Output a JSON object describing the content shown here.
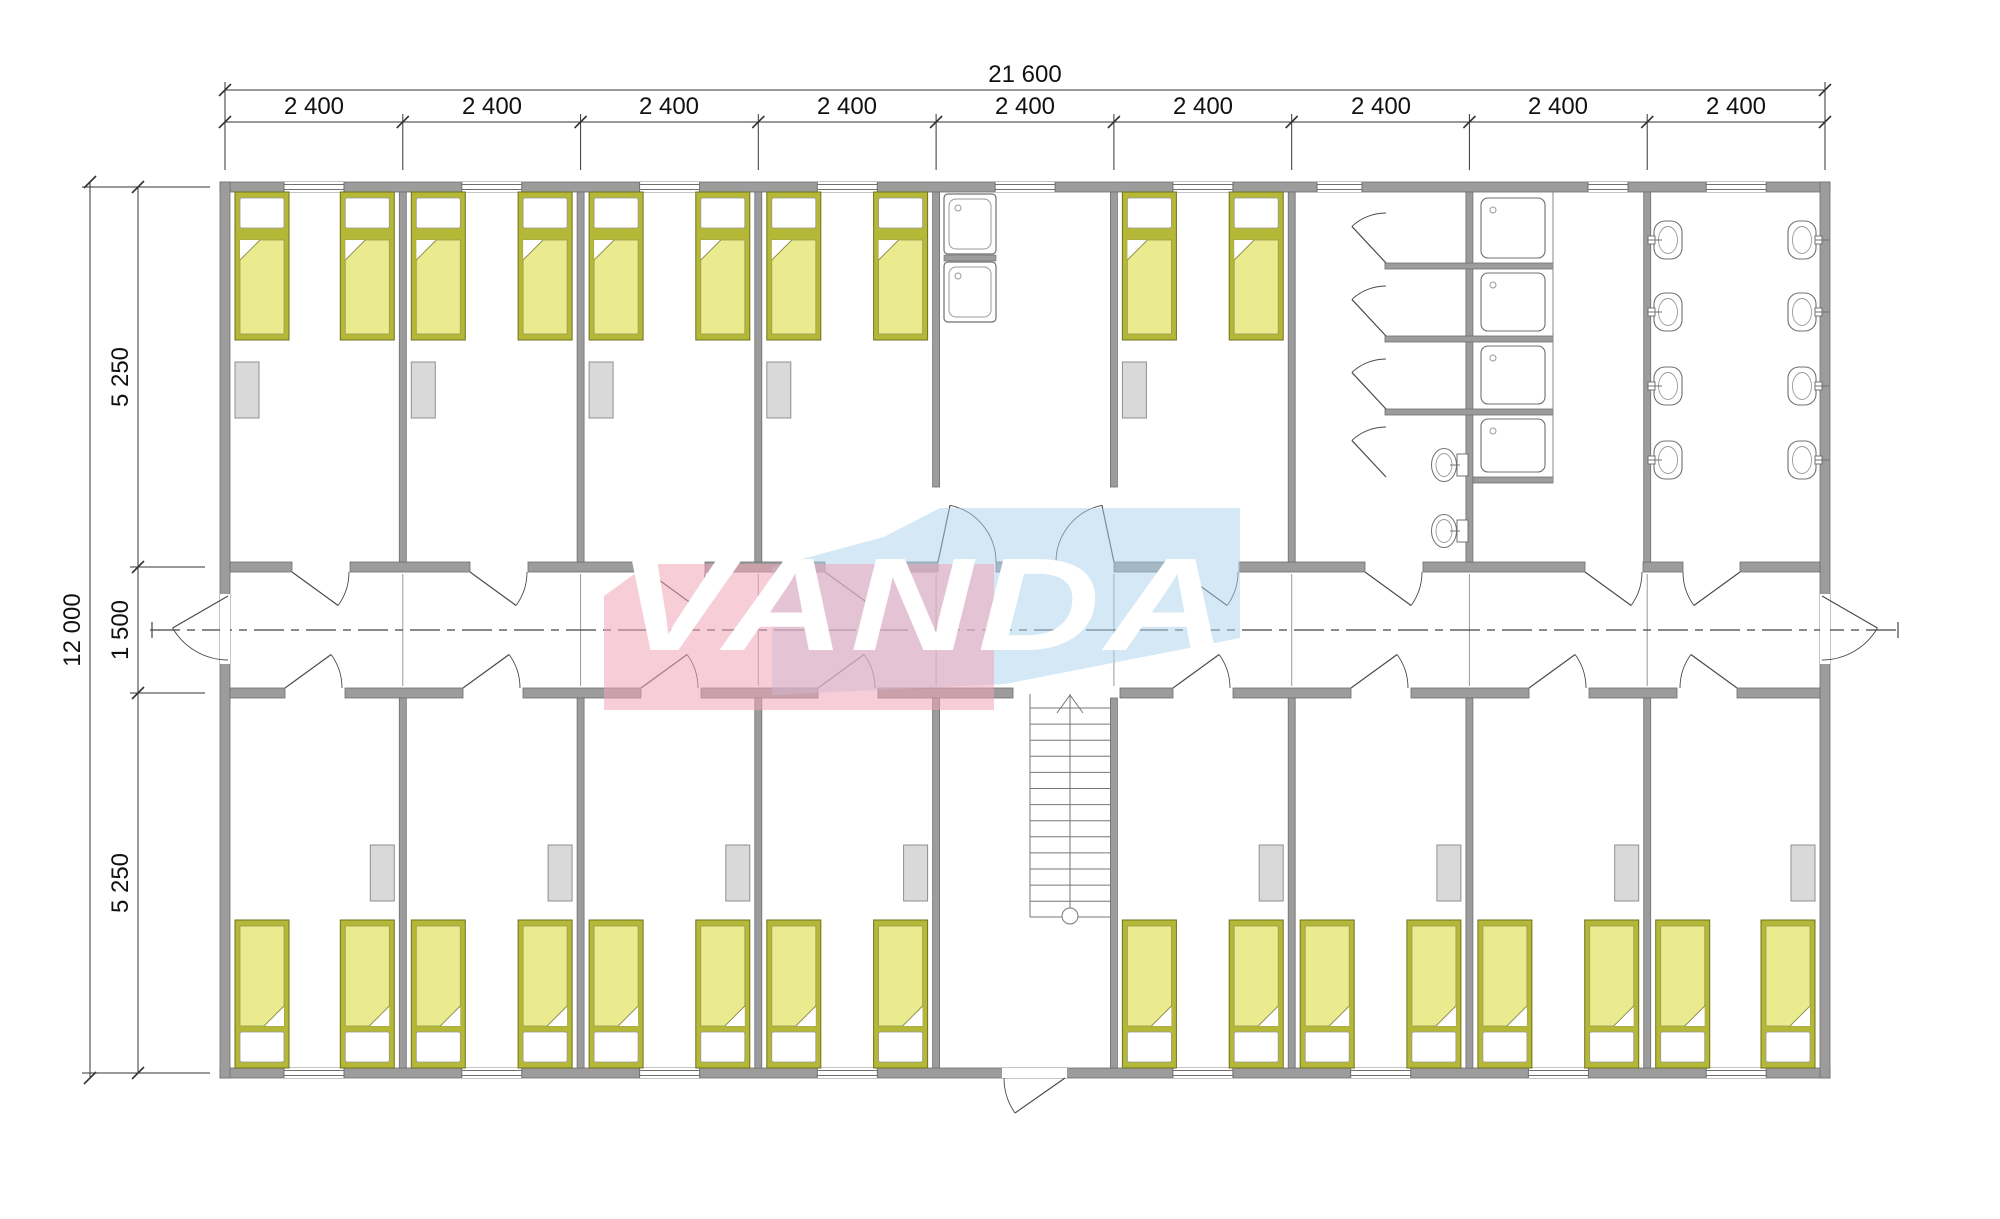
{
  "watermark": {
    "text": "VANDA",
    "pink": "#f0a6b8",
    "blue": "#a9d2ec",
    "pink_opacity": 0.55,
    "blue_opacity": 0.5,
    "text_color": "#ffffff"
  },
  "dims": {
    "total_width": "21 600",
    "module_labels": [
      "2 400",
      "2 400",
      "2 400",
      "2 400",
      "2 400",
      "2 400",
      "2 400",
      "2 400",
      "2 400"
    ],
    "total_height": "12 000",
    "seg_top": "5 250",
    "seg_corridor": "1 500",
    "seg_bottom": "5 250"
  },
  "colors": {
    "wall_fill": "#9c9c9c",
    "wall_stroke": "#6f6f6f",
    "bed_frame": "#b4b836",
    "bed_blanket": "#e9eb8e",
    "bed_pillow": "#ffffff",
    "furniture_fill": "#d9d9d9",
    "furniture_stroke": "#8f8f8f",
    "fixture_stroke": "#707070",
    "door_line": "#4a4a4a",
    "axis_line": "#999999",
    "center_line": "#444444",
    "dim_line": "#333333"
  },
  "building": {
    "modules": 9,
    "corridor_position": "central",
    "rooms_top": [
      {
        "module": 1,
        "type": "bedroom",
        "beds": 2,
        "wardrobes": 1
      },
      {
        "module": 2,
        "type": "bedroom",
        "beds": 2,
        "wardrobes": 1
      },
      {
        "module": 3,
        "type": "bedroom",
        "beds": 2,
        "wardrobes": 1
      },
      {
        "module": 4,
        "type": "bedroom",
        "beds": 2,
        "wardrobes": 1
      },
      {
        "module": 5,
        "type": "kitchen",
        "sinks": 2,
        "corridor_doors": 2
      },
      {
        "module": 6,
        "type": "bedroom",
        "beds": 2,
        "wardrobes": 1
      },
      {
        "module": 7,
        "type": "sanitary-stalls",
        "stalls": 4,
        "toilets": 2
      },
      {
        "module": 8,
        "type": "showers",
        "shower_trays": 4
      },
      {
        "module": 9,
        "type": "washroom",
        "washbasins": 8
      }
    ],
    "rooms_bottom": [
      {
        "module": 1,
        "type": "bedroom",
        "beds": 2,
        "wardrobes": 1
      },
      {
        "module": 2,
        "type": "bedroom",
        "beds": 2,
        "wardrobes": 1
      },
      {
        "module": 3,
        "type": "bedroom",
        "beds": 2,
        "wardrobes": 1
      },
      {
        "module": 4,
        "type": "bedroom",
        "beds": 2,
        "wardrobes": 1
      },
      {
        "module": 5,
        "type": "stair-hall",
        "stairs": 1,
        "entrance_doors": 1
      },
      {
        "module": 6,
        "type": "bedroom",
        "beds": 2,
        "wardrobes": 1
      },
      {
        "module": 7,
        "type": "bedroom",
        "beds": 2,
        "wardrobes": 1
      },
      {
        "module": 8,
        "type": "bedroom",
        "beds": 2,
        "wardrobes": 1
      },
      {
        "module": 9,
        "type": "bedroom",
        "beds": 2,
        "wardrobes": 1
      }
    ],
    "exits": [
      "corridor-left-end",
      "corridor-right-end",
      "main-entrance-bottom-center"
    ]
  }
}
